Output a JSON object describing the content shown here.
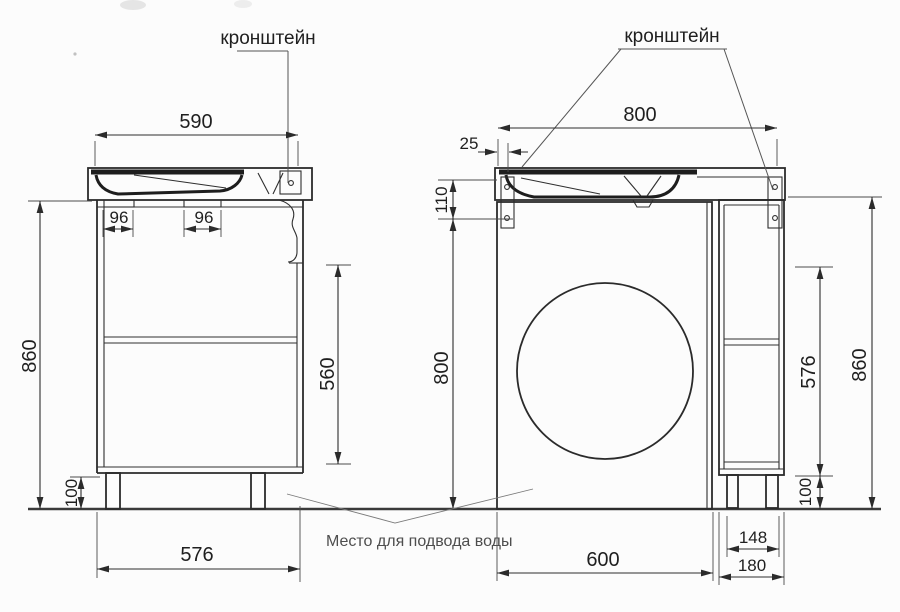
{
  "labels": {
    "bracket_left": "кронштейн",
    "bracket_right": "кронштейн",
    "water_supply_note": "Место для подвода воды"
  },
  "left_view": {
    "description": "cabinet-with-washbasin-front-section",
    "dims": {
      "sink_width": "590",
      "cutout_left": "96",
      "cutout_center": "96",
      "height": "860",
      "drawer_zone_height": "560",
      "leg_height": "100",
      "body_width": "576"
    }
  },
  "right_view": {
    "description": "washbasin-over-washing-machine-with-side-cabinet",
    "dims": {
      "countertop_width": "800",
      "edge_offset": "25",
      "apron_height": "110",
      "niche_height": "800",
      "cabinet_inner_height": "576",
      "total_height": "860",
      "leg_height": "100",
      "leg_span": "148",
      "niche_width": "600",
      "cabinet_width": "180"
    }
  },
  "colors": {
    "ink": "#2b2b2b",
    "background": "#fcfcfc",
    "note_text": "#4e4e4e"
  }
}
